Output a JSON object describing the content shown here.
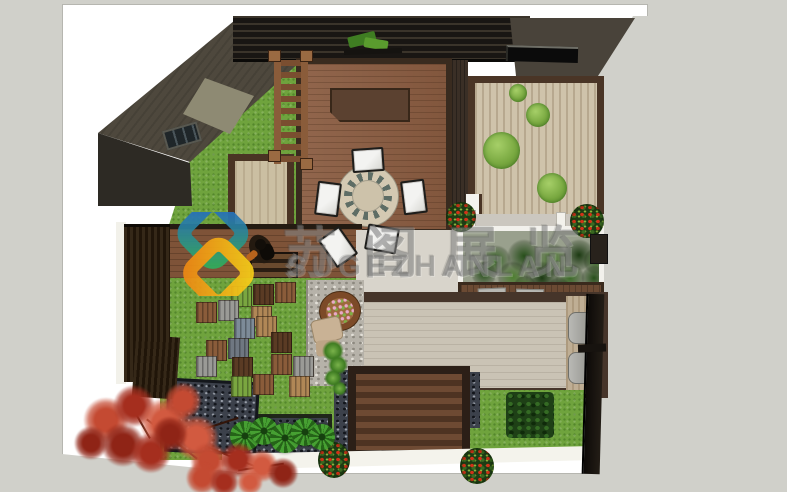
{
  "meta": {
    "title": "courtyard-garden-top-view-render"
  },
  "watermark": {
    "cn_text": "苏阁展览",
    "en_text": "SUGEZHANLAN",
    "color": "rgba(108,108,108,0.42)"
  },
  "logo": {
    "name": "suge-zhanlan-logo",
    "ribbon_blue_green": [
      "#2563cf",
      "#2fae5e"
    ],
    "ribbon_yellow_orange": [
      "#f6cd18",
      "#ee8a14"
    ]
  },
  "palette": {
    "background": "#d0d0ca",
    "sheet": "#ffffff",
    "lawn": "#6fa33d",
    "deck_wood": "#8a5c41",
    "patio_stone": "#cac3b5",
    "roof_dark": "#4e483d",
    "courtyard_tan": "#cfc3ab",
    "fence_black": "#17130f",
    "tiles": {
      "brown": "#8a5c3a",
      "dkbrown": "#5a3b24",
      "gray": "#9a9a96",
      "blue": "#7d8b98",
      "green": "#7aa640",
      "tan": "#b08756",
      "slate": "#6f7781"
    },
    "maple": [
      "#c44a32",
      "#a52e1e",
      "#d25a40",
      "#8f2416"
    ],
    "hedge": [
      "#3c6b28",
      "#27501a",
      "#4e7f30",
      "#1c3a12"
    ]
  },
  "scene": {
    "moss": [
      {
        "x": 509,
        "y": 84,
        "d": 18
      },
      {
        "x": 526,
        "y": 103,
        "d": 24
      },
      {
        "x": 483,
        "y": 132,
        "d": 37
      },
      {
        "x": 537,
        "y": 173,
        "d": 30
      }
    ],
    "chairs": [
      {
        "x": 352,
        "y": 148,
        "w": 32,
        "h": 24,
        "r": -4
      },
      {
        "x": 316,
        "y": 182,
        "w": 24,
        "h": 34,
        "r": 7
      },
      {
        "x": 402,
        "y": 180,
        "w": 24,
        "h": 34,
        "r": -7
      },
      {
        "x": 366,
        "y": 226,
        "w": 32,
        "h": 26,
        "r": 10
      },
      {
        "x": 325,
        "y": 230,
        "w": 26,
        "h": 34,
        "r": -35
      }
    ],
    "tiles": [
      {
        "x": 231,
        "y": 286,
        "c": "green"
      },
      {
        "x": 253,
        "y": 284,
        "c": "dkbrown"
      },
      {
        "x": 275,
        "y": 282,
        "c": "brown"
      },
      {
        "x": 196,
        "y": 302,
        "c": "brown"
      },
      {
        "x": 218,
        "y": 300,
        "c": "gray"
      },
      {
        "x": 251,
        "y": 306,
        "c": "tan"
      },
      {
        "x": 234,
        "y": 318,
        "c": "blue"
      },
      {
        "x": 256,
        "y": 316,
        "c": "tan"
      },
      {
        "x": 271,
        "y": 332,
        "c": "dkbrown"
      },
      {
        "x": 228,
        "y": 338,
        "c": "slate"
      },
      {
        "x": 206,
        "y": 340,
        "c": "brown"
      },
      {
        "x": 271,
        "y": 354,
        "c": "brown"
      },
      {
        "x": 293,
        "y": 356,
        "c": "gray"
      },
      {
        "x": 196,
        "y": 356,
        "c": "gray"
      },
      {
        "x": 232,
        "y": 357,
        "c": "dkbrown"
      },
      {
        "x": 231,
        "y": 376,
        "c": "green"
      },
      {
        "x": 253,
        "y": 374,
        "c": "brown"
      },
      {
        "x": 289,
        "y": 376,
        "c": "tan"
      }
    ],
    "hedge_blobs": [
      {
        "x": 18,
        "y": 14,
        "d": 30
      },
      {
        "x": 44,
        "y": 8,
        "d": 34
      },
      {
        "x": 72,
        "y": 12,
        "d": 34
      },
      {
        "x": 100,
        "y": 8,
        "d": 32
      },
      {
        "x": 120,
        "y": 16,
        "d": 28
      },
      {
        "x": 8,
        "y": 30,
        "d": 26
      },
      {
        "x": 34,
        "y": 30,
        "d": 32
      },
      {
        "x": 62,
        "y": 30,
        "d": 34
      },
      {
        "x": 92,
        "y": 32,
        "d": 30
      },
      {
        "x": 118,
        "y": 34,
        "d": 26
      },
      {
        "x": 50,
        "y": 44,
        "d": 24
      },
      {
        "x": 84,
        "y": 46,
        "d": 24
      }
    ],
    "leaf_plants": [
      {
        "x": 230,
        "y": 421,
        "d": 30
      },
      {
        "x": 250,
        "y": 417,
        "d": 28
      },
      {
        "x": 270,
        "y": 423,
        "d": 30
      },
      {
        "x": 291,
        "y": 418,
        "d": 28
      },
      {
        "x": 309,
        "y": 424,
        "d": 26
      }
    ],
    "vine": [
      {
        "x": 322,
        "y": 340,
        "d": 22
      },
      {
        "x": 328,
        "y": 355,
        "d": 20
      },
      {
        "x": 324,
        "y": 369,
        "d": 18
      },
      {
        "x": 332,
        "y": 381,
        "d": 15
      }
    ],
    "maple_blobs": [
      {
        "x": 78,
        "y": 392,
        "d": 56
      },
      {
        "x": 108,
        "y": 380,
        "d": 52
      },
      {
        "x": 134,
        "y": 392,
        "d": 62
      },
      {
        "x": 96,
        "y": 418,
        "d": 54
      },
      {
        "x": 160,
        "y": 378,
        "d": 46
      },
      {
        "x": 126,
        "y": 428,
        "d": 50
      },
      {
        "x": 168,
        "y": 410,
        "d": 56
      },
      {
        "x": 70,
        "y": 422,
        "d": 42
      },
      {
        "x": 186,
        "y": 438,
        "d": 46
      },
      {
        "x": 216,
        "y": 438,
        "d": 44
      },
      {
        "x": 242,
        "y": 446,
        "d": 40
      },
      {
        "x": 264,
        "y": 454,
        "d": 38
      },
      {
        "x": 182,
        "y": 458,
        "d": 40
      },
      {
        "x": 206,
        "y": 464,
        "d": 36
      },
      {
        "x": 234,
        "y": 466,
        "d": 32
      },
      {
        "x": 148,
        "y": 412,
        "d": 44
      }
    ],
    "branches": [
      {
        "x": 140,
        "y": 438,
        "w": 64,
        "r": 38
      },
      {
        "x": 168,
        "y": 428,
        "w": 72,
        "r": -18
      },
      {
        "x": 206,
        "y": 456,
        "w": 52,
        "r": 22
      },
      {
        "x": 238,
        "y": 466,
        "w": 46,
        "r": -8
      },
      {
        "x": 120,
        "y": 420,
        "w": 40,
        "r": 60
      }
    ]
  }
}
